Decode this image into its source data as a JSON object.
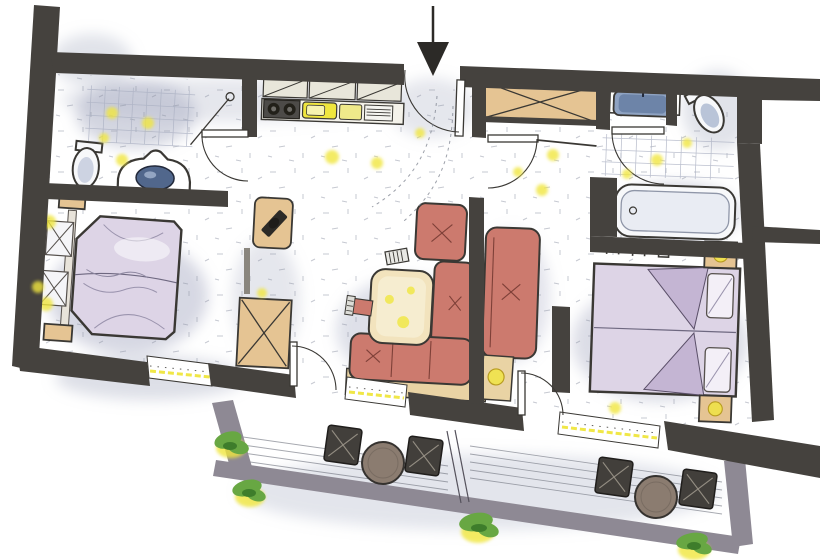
{
  "colors": {
    "paper": "#ffffff",
    "wall": "#45423e",
    "parapet": "#8e8994",
    "shade": "#a9aec4",
    "speck": "#8e93a4",
    "tan": "#e5c493",
    "tanLight": "#f2e3bd",
    "platform": "#e9d3a4",
    "red": "#cc7a6e",
    "redDark": "#7e4038",
    "lavender": "#ddd4e6",
    "lavenderDeep": "#c4b5d3",
    "blue": "#8fa3c2",
    "blueDeep": "#51678c",
    "yellow": "#f0e63e",
    "green": "#68a743",
    "greenDark": "#3e7d2b",
    "table": "#8b7c70",
    "deck": "#6b6f7a",
    "ink": "#3a3834",
    "tile": "#aab0c2",
    "fixture": "#f7f8fa"
  },
  "icons": {
    "entry_arrow": "▼"
  },
  "plan": {
    "rooms": [
      {
        "name": "bathroom-left",
        "fixtures": [
          "shower",
          "toilet",
          "washbasin"
        ]
      },
      {
        "name": "kitchen",
        "fixtures": [
          "upper-cabinets",
          "cooktop",
          "sink",
          "appliance"
        ]
      },
      {
        "name": "bedroom-left",
        "fixtures": [
          "double-bed",
          "nightstands",
          "tv-cabinet",
          "wardrobe"
        ]
      },
      {
        "name": "living-area",
        "fixtures": [
          "corner-sofa",
          "coffee-table",
          "armchair",
          "daybed"
        ]
      },
      {
        "name": "bathroom-right",
        "fixtures": [
          "washbasin",
          "toilet",
          "bathtub"
        ]
      },
      {
        "name": "bedroom-right",
        "fixtures": [
          "double-bed",
          "nightstands",
          "reading-lights"
        ]
      },
      {
        "name": "balcony",
        "fixtures": [
          "chairs",
          "round-tables",
          "plants"
        ]
      }
    ],
    "balcony": {
      "chairs": 4,
      "tables": 2,
      "plants": 4
    },
    "doors": 6,
    "windows": 3
  }
}
